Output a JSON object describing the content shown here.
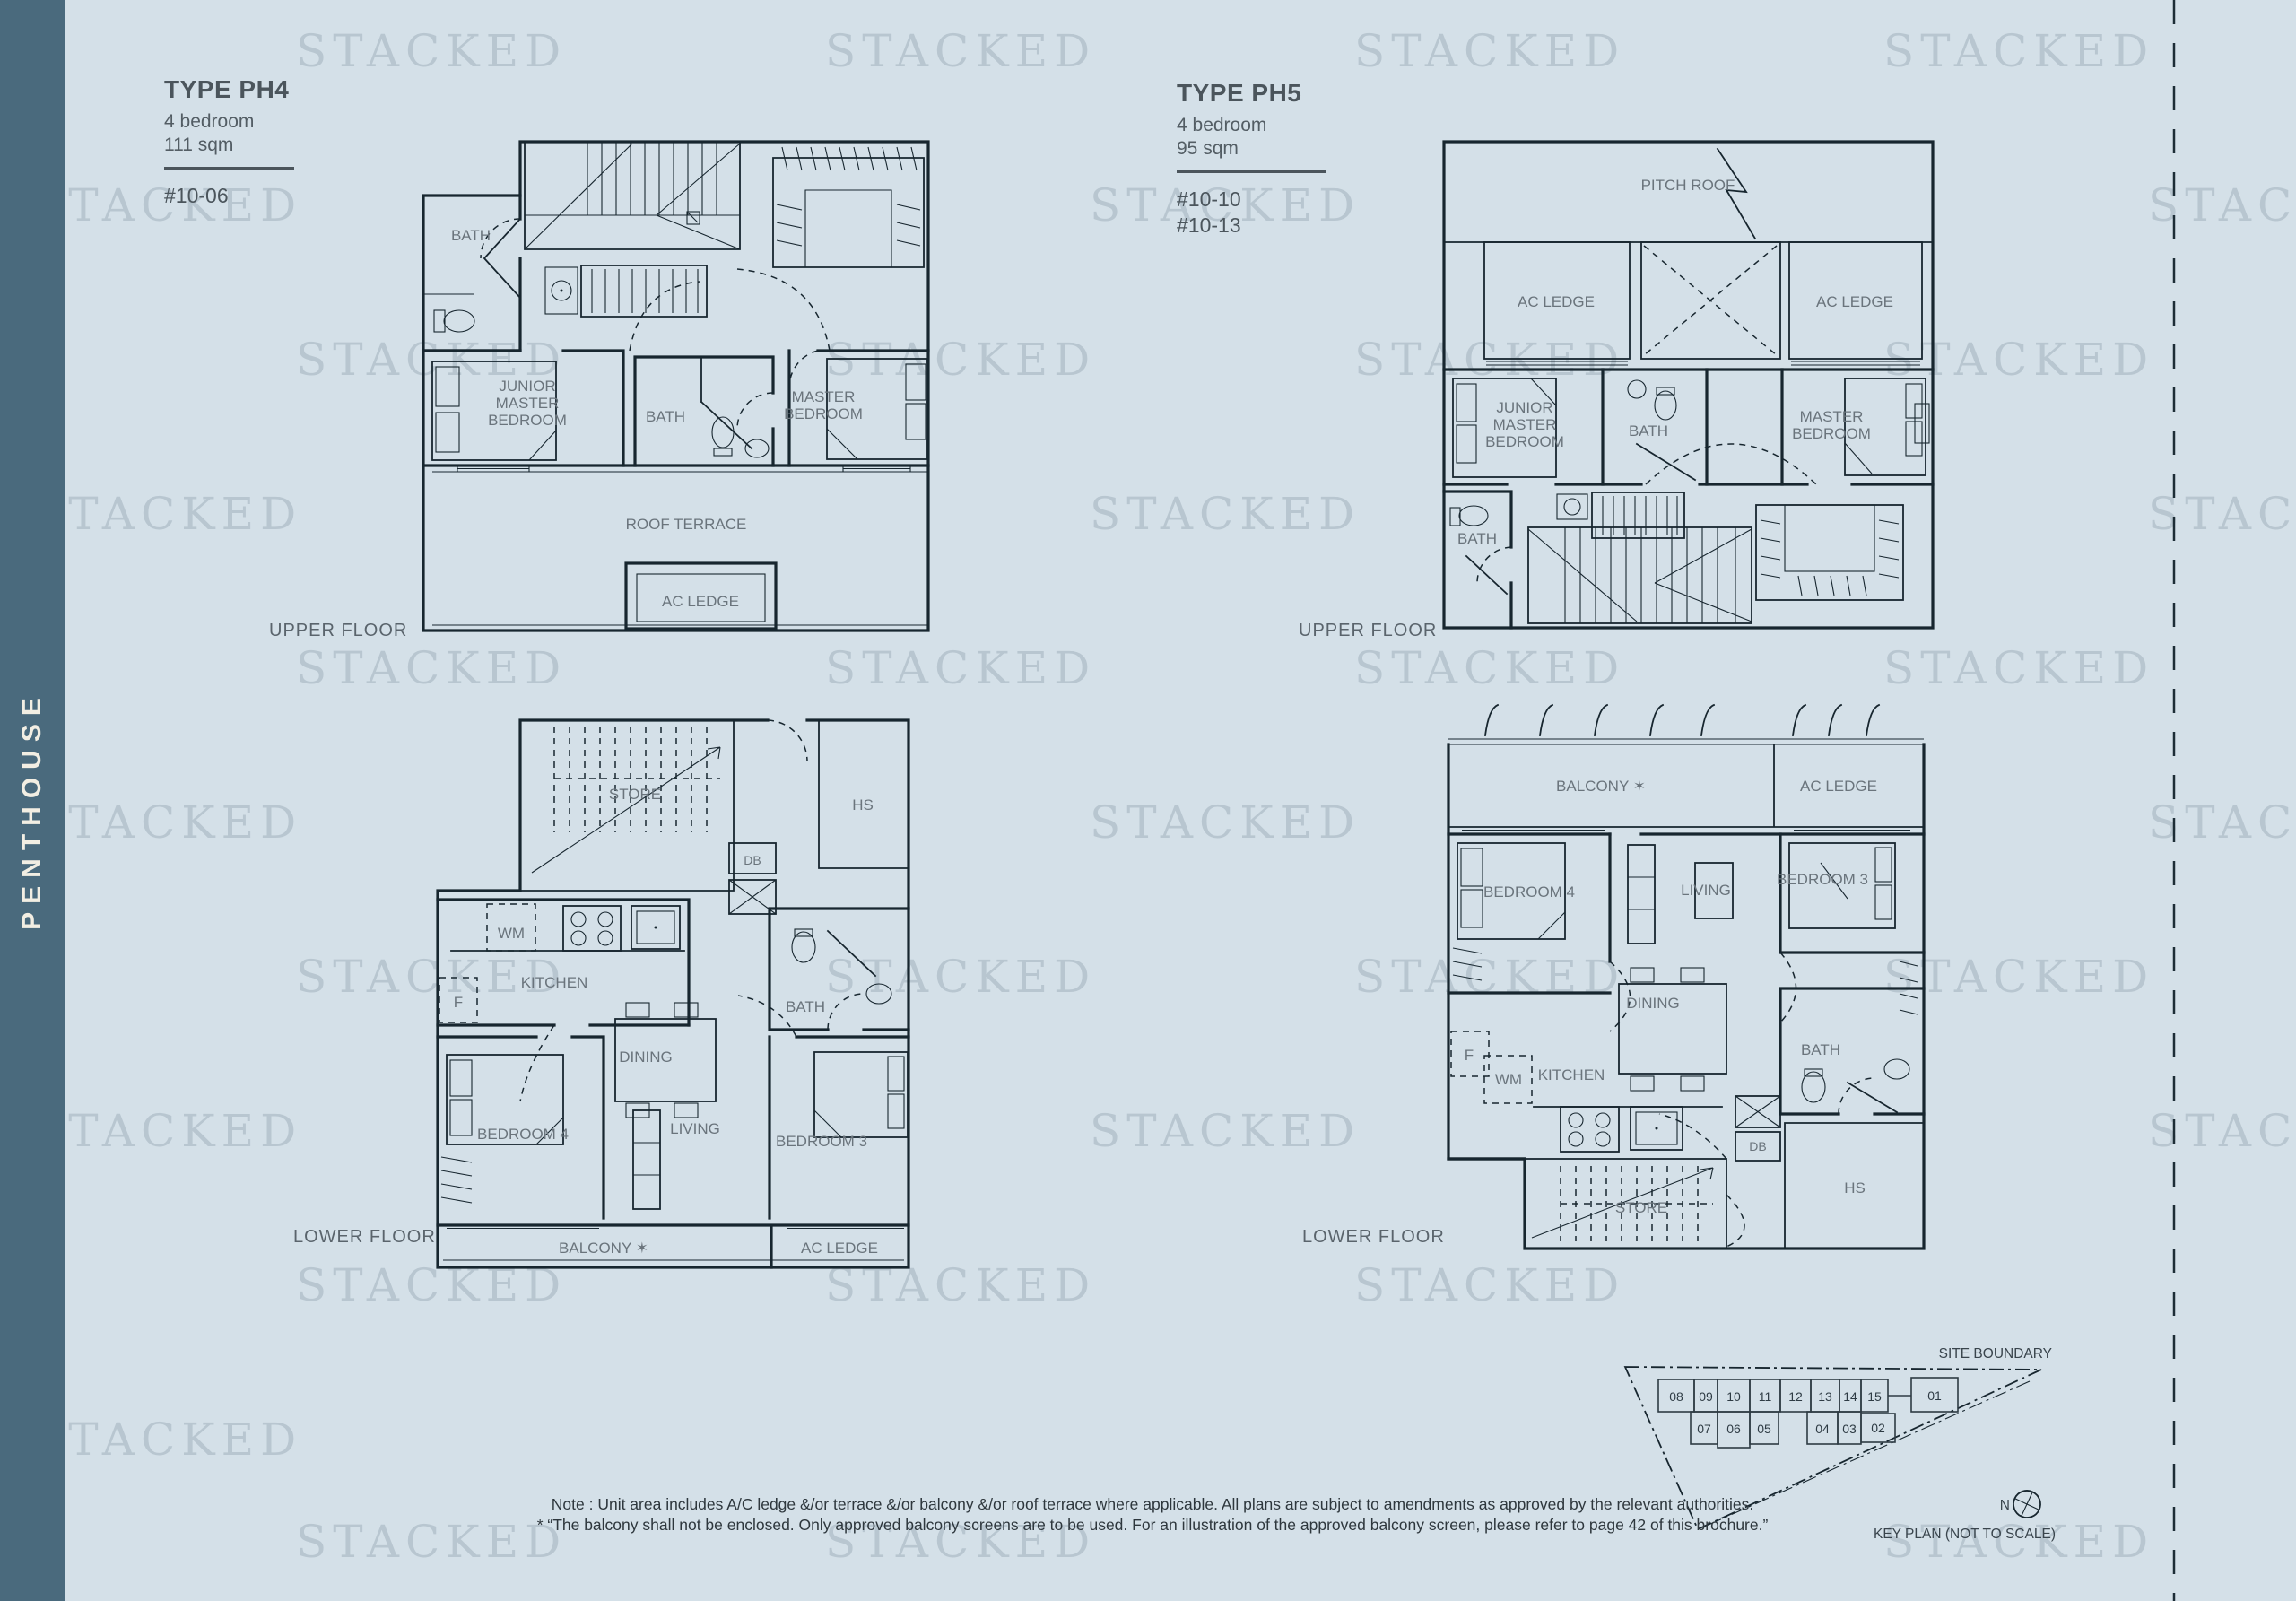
{
  "page": {
    "bg_color": "#d4e0e8",
    "line_color": "#17262f",
    "watermark": {
      "text": "STACKED"
    },
    "sidebar": {
      "label": "PENTHOUSE",
      "bg_color": "#4a6a7d",
      "text_color": "#f2eee3"
    },
    "note": {
      "line1": "Note : Unit area includes A/C ledge &/or terrace &/or balcony &/or roof terrace where applicable. All plans are subject to amendments as approved by the relevant authorities.",
      "line2": "* “The balcony shall not be enclosed. Only approved balcony screens are to be used. For an illustration of the approved balcony screen, please refer to page 42 of this brochure.”"
    }
  },
  "units": {
    "ph4": {
      "title": "TYPE PH4",
      "bedrooms": "4 bedroom",
      "area": "111 sqm",
      "stack": "#10-06"
    },
    "ph5": {
      "title": "TYPE PH5",
      "bedrooms": "4 bedroom",
      "area": "95 sqm",
      "stack1": "#10-10",
      "stack2": "#10-13"
    }
  },
  "plans": {
    "ph4_upper": {
      "floor_label": "UPPER FLOOR",
      "bath_top": "BATH",
      "junior_l1": "JUNIOR",
      "junior_l2": "MASTER",
      "junior_l3": "BEDROOM",
      "bath_mid": "BATH",
      "master_l1": "MASTER",
      "master_l2": "BEDROOM",
      "roof_terrace": "ROOF TERRACE",
      "ac_ledge": "AC LEDGE"
    },
    "ph5_upper": {
      "floor_label": "UPPER FLOOR",
      "pitch_roof": "PITCH ROOF",
      "ac_ledge_left": "AC LEDGE",
      "ac_ledge_right": "AC LEDGE",
      "junior_l1": "JUNIOR",
      "junior_l2": "MASTER",
      "junior_l3": "BEDROOM",
      "bath_top": "BATH",
      "master_l1": "MASTER",
      "master_l2": "BEDROOM",
      "bath_bottom": "BATH"
    },
    "ph4_lower": {
      "floor_label": "LOWER FLOOR",
      "store": "STORE",
      "hs": "HS",
      "db": "DB",
      "wm": "WM",
      "kitchen": "KITCHEN",
      "f": "F",
      "bath": "BATH",
      "dining": "DINING",
      "bedroom4": "BEDROOM 4",
      "living": "LIVING",
      "bedroom3": "BEDROOM 3",
      "balcony": "BALCONY ✶",
      "ac_ledge": "AC LEDGE"
    },
    "ph5_lower": {
      "floor_label": "LOWER FLOOR",
      "balcony": "BALCONY ✶",
      "ac_ledge": "AC LEDGE",
      "bedroom4": "BEDROOM 4",
      "living": "LIVING",
      "bedroom3": "BEDROOM 3",
      "dining": "DINING",
      "f": "F",
      "kitchen": "KITCHEN",
      "wm": "WM",
      "bath": "BATH",
      "db": "DB",
      "hs": "HS",
      "store": "STORE"
    }
  },
  "keyplan": {
    "site_boundary_label": "SITE BOUNDARY",
    "caption": "KEY PLAN (NOT TO SCALE)",
    "north_label": "N",
    "row1": [
      "08",
      "09",
      "10",
      "11",
      "12",
      "13",
      "14",
      "15",
      "01"
    ],
    "row2": [
      "07",
      "06",
      "05",
      "04",
      "03",
      "02"
    ],
    "highlighted_brown_units": [
      "10",
      "13"
    ],
    "highlighted_yellow_units": [
      "06"
    ],
    "brown_color": "#9b8174",
    "yellow_color": "#ffe600"
  }
}
